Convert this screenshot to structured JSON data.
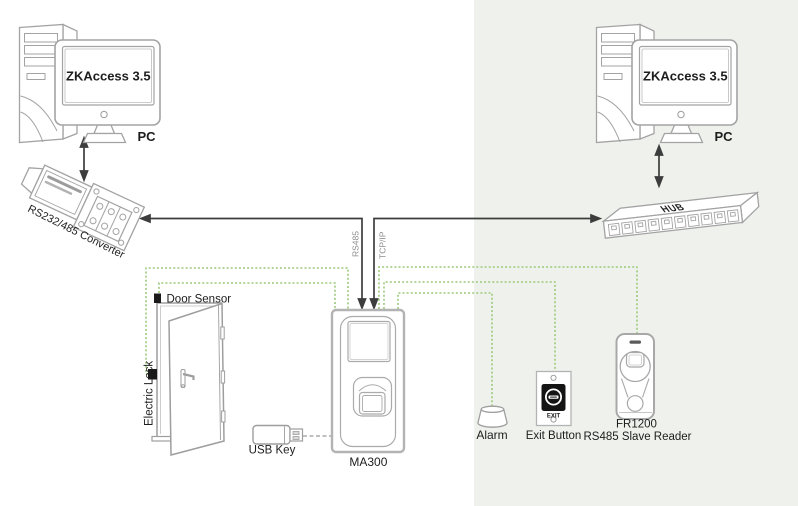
{
  "background": {
    "left_color": "#ffffff",
    "right_color": "#eff2ec"
  },
  "palette": {
    "line": "#3d3d3d",
    "wire_green": "#9cc97a",
    "outline": "#a3a3a3",
    "text": "#1d1d1d",
    "muted_text": "#8c8c8c"
  },
  "pc_left": {
    "screen_label": "ZKAccess 3.5",
    "label": "PC"
  },
  "pc_right": {
    "screen_label": "ZKAccess 3.5",
    "label": "PC"
  },
  "converter": {
    "label": "RS232/485 Converter"
  },
  "hub": {
    "label": "HUB"
  },
  "links": {
    "rs485": "RS485",
    "tcpip": "TCP/IP"
  },
  "door": {
    "sensor_label": "Door Sensor",
    "lock_label": "Electric Lock"
  },
  "usb_key": {
    "label": "USB Key"
  },
  "ma300": {
    "label": "MA300"
  },
  "alarm": {
    "label": "Alarm"
  },
  "exit_button": {
    "label": "Exit Button",
    "button_text": "EXIT"
  },
  "fr1200": {
    "label": "FR1200",
    "sublabel": "RS485 Slave Reader"
  }
}
